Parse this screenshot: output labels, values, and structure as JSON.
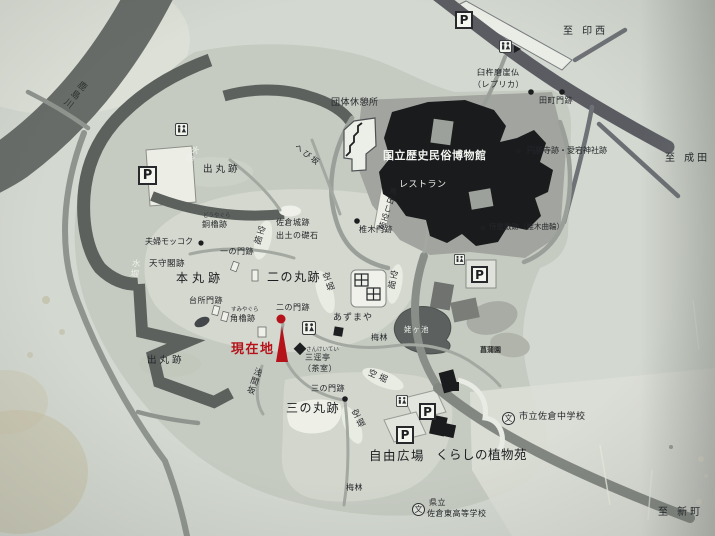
{
  "colors": {
    "paper": "#d3d8d0",
    "park": "#c6cbc2",
    "water": "#62665f",
    "building": "#1a1b1d",
    "current_location_red": "#b5121a"
  },
  "icons": {
    "parking": "P",
    "school": "文"
  },
  "labels": {
    "river": "鹿島川",
    "dir_inzai": "至 印西",
    "dir_narita": "至 成田",
    "dir_shinmachi": "至 新町",
    "group_rest_house": "団体休憩所",
    "museum": "国立歴史民俗博物館",
    "restaurant": "レストラン",
    "usuki_magaibutsu": "臼杵磨崖仏",
    "usuki_replica": "（レプリカ）",
    "tamachi_gate": "田町門跡",
    "enshoji_atago": "円勝寺跡・愛宕神社跡",
    "samurai_residence": "侍屋敷跡（椎木曲輪）",
    "shiinoki_gate": "椎木門跡",
    "umadashi_karabori": "馬出し空堀",
    "hebizaka": "へび坂",
    "foundation_stone_1": "佐倉城跡",
    "foundation_stone_2": "出土の礎石",
    "demaru": "出丸跡",
    "mizubori": "水堀",
    "honmaru": "本丸跡",
    "ninomaru": "二の丸跡",
    "sannomaru": "三の丸跡",
    "tenshukaku": "天守閣跡",
    "meoto_mokkoku": "夫婦モッコク",
    "dou_yagura": "銅櫓跡",
    "dou_yagura_kana": "どうやぐら",
    "ichinomon": "一の門跡",
    "daidokoro_gate": "台所門跡",
    "sumi_yagura": "角櫓跡",
    "sumi_yagura_kana": "すみやぐら",
    "ninomon": "二の門跡",
    "current_location": "現在地",
    "sengenzaka": "浅間坂",
    "sankeitei": "三逕亭",
    "sankeitei_kana": "さんけいてい",
    "sankeitei_note": "（茶室）",
    "sannomon": "三の門跡",
    "azumaya": "あずまや",
    "ubagaike": "姥ヶ池",
    "bairin": "梅林",
    "karabori": "空堀",
    "shobuen": "菖蒲園",
    "jiyu_hiroba": "自由広場",
    "kurashi_garden": "くらしの植物苑",
    "junior_high": "市立佐倉中学校",
    "pref_label": "県立",
    "high_school": "佐倉東高等学校"
  }
}
